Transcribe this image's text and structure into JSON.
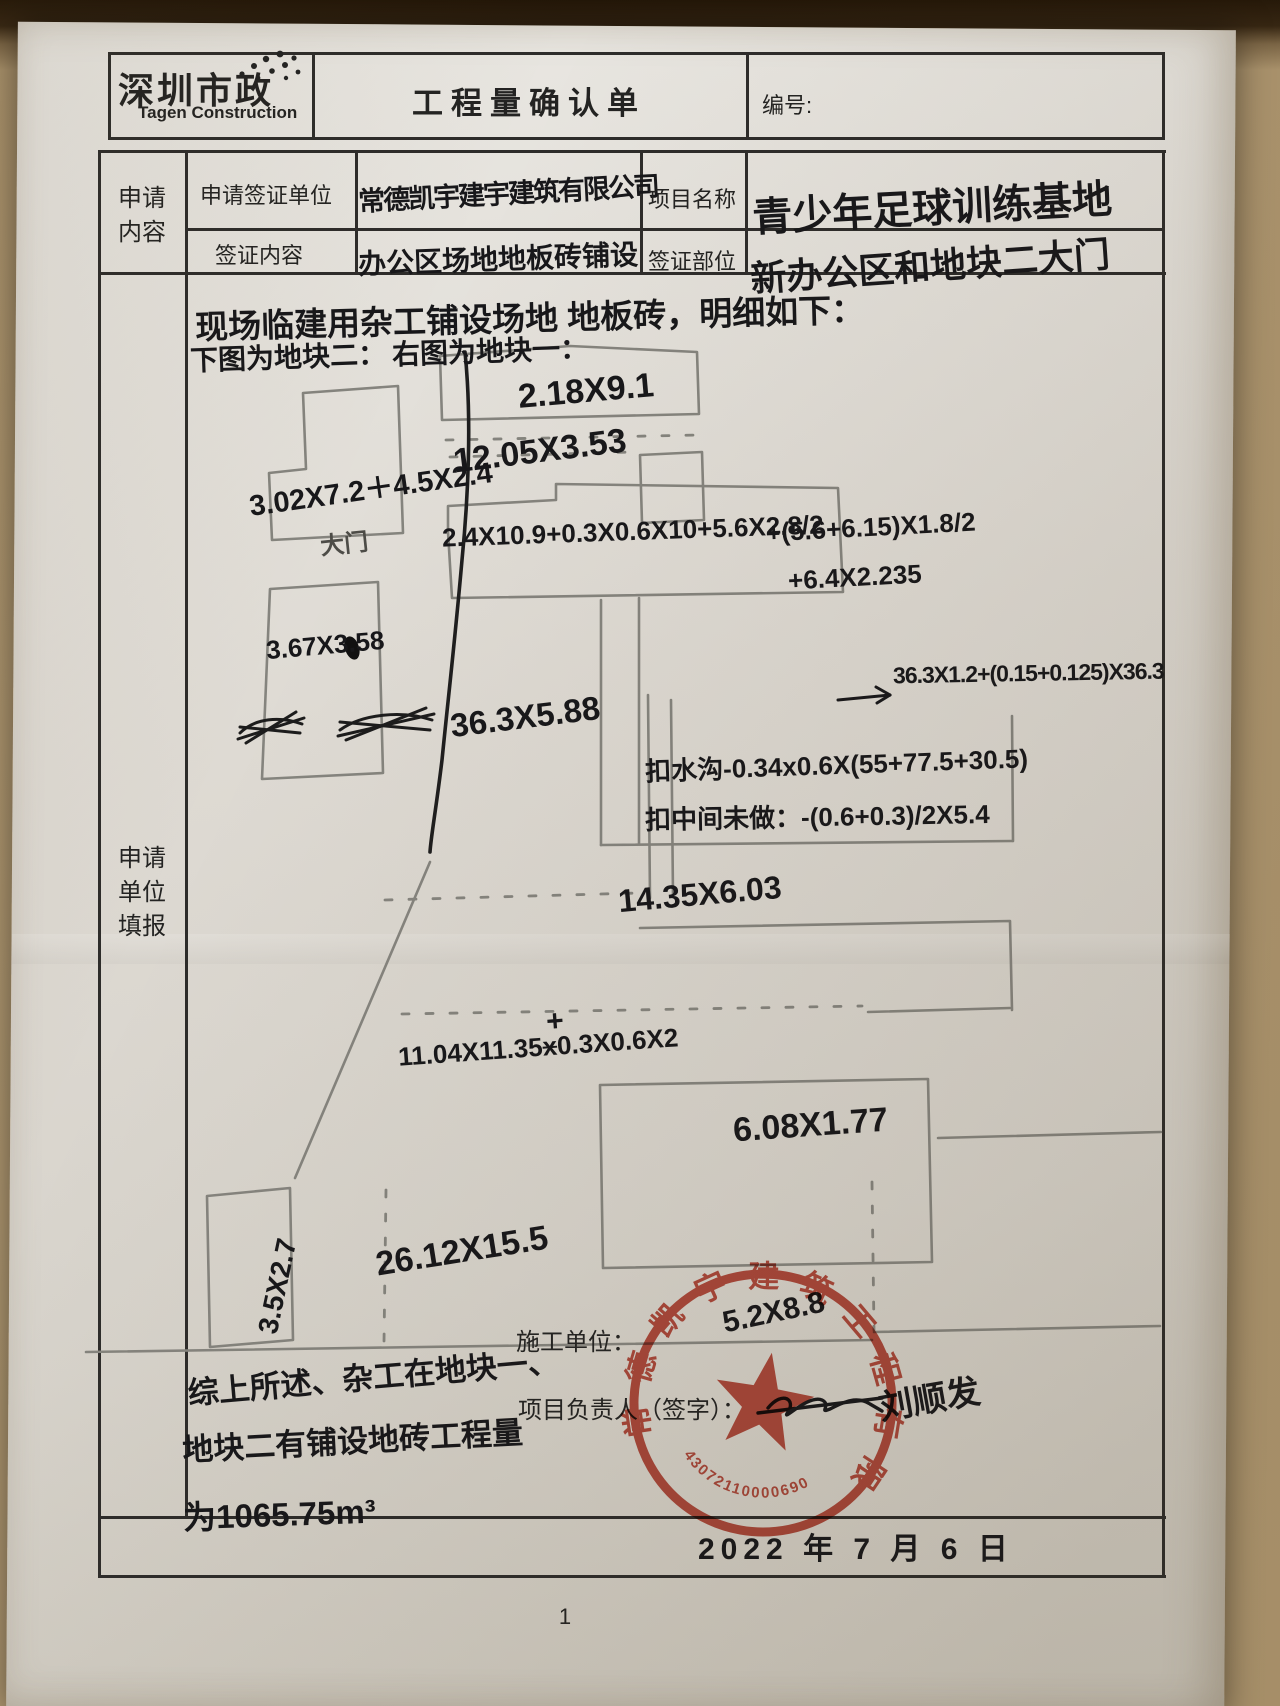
{
  "colors": {
    "stamp_red": "#bf3a2b",
    "ink": "#17171a",
    "pencil": "#85847e"
  },
  "header": {
    "logo_cn": "深圳市政",
    "logo_en": "Tagen Construction",
    "title": "工程量确认单",
    "no_label": "编号:"
  },
  "info": {
    "section_l1": "申请",
    "section_l2": "内容",
    "row1_label": "申请签证单位",
    "row1_value": "常德凯宇建宇建筑有限公司",
    "row1_label2": "项目名称",
    "row1_value2": "青少年足球训练基地",
    "row2_label": "签证内容",
    "row2_value": "办公区场地地板砖铺设",
    "row2_label2": "签证部位",
    "row2_value2": "新办公区和地块二大门"
  },
  "main": {
    "side_l1": "申请",
    "side_l2": "单位",
    "side_l3": "填报",
    "intro1": "现场临建用杂工铺设场地 地板砖，明细如下：",
    "intro2a": "下图为地块二：",
    "intro2b": "右图为地块一：",
    "gate_label": "大门",
    "m": {
      "r1": "2.18X9.1",
      "r2": "12.05X3.53",
      "l1": "3.02X7.2＋4.5X2.4",
      "f1": "2.4X10.9+0.3X0.6X10+5.6X2.8/2",
      "f2": "+(5.6+6.15)X1.8/2",
      "f3": "+6.4X2.235",
      "l2": "3.67X3.58",
      "r3": "36.3X5.88",
      "f4": "36.3X1.2+(0.15+0.125)X36.3",
      "d1": "扣水沟-0.34x0.6X(55+77.5+30.5)",
      "d2": "扣中间未做：-(0.6+0.3)/2X5.4",
      "r4": "14.35X6.03",
      "f5a": "11.04X11.35",
      "f5x": "x",
      "f5plus": "+",
      "f5c": "0.3X0.6X2",
      "r5": "6.08X1.77",
      "r6": "26.12X15.5",
      "l3": "3.5X2.7",
      "r7": "5.2X8.8"
    },
    "summary1": "综上所述、杂工在地块一、",
    "summary2": "地块二有铺设地砖工程量",
    "summary3": "为1065.75m³",
    "unit_label": "施工单位：",
    "manager_label": "项目负责人（签字）：",
    "signature": "刘顺发",
    "date": "2022 年 7 月 6 日"
  },
  "stamp": {
    "company": "常德凯宇建筑工程有限公司",
    "serial": "43072110000690"
  },
  "footer": {
    "page_number": "1"
  }
}
